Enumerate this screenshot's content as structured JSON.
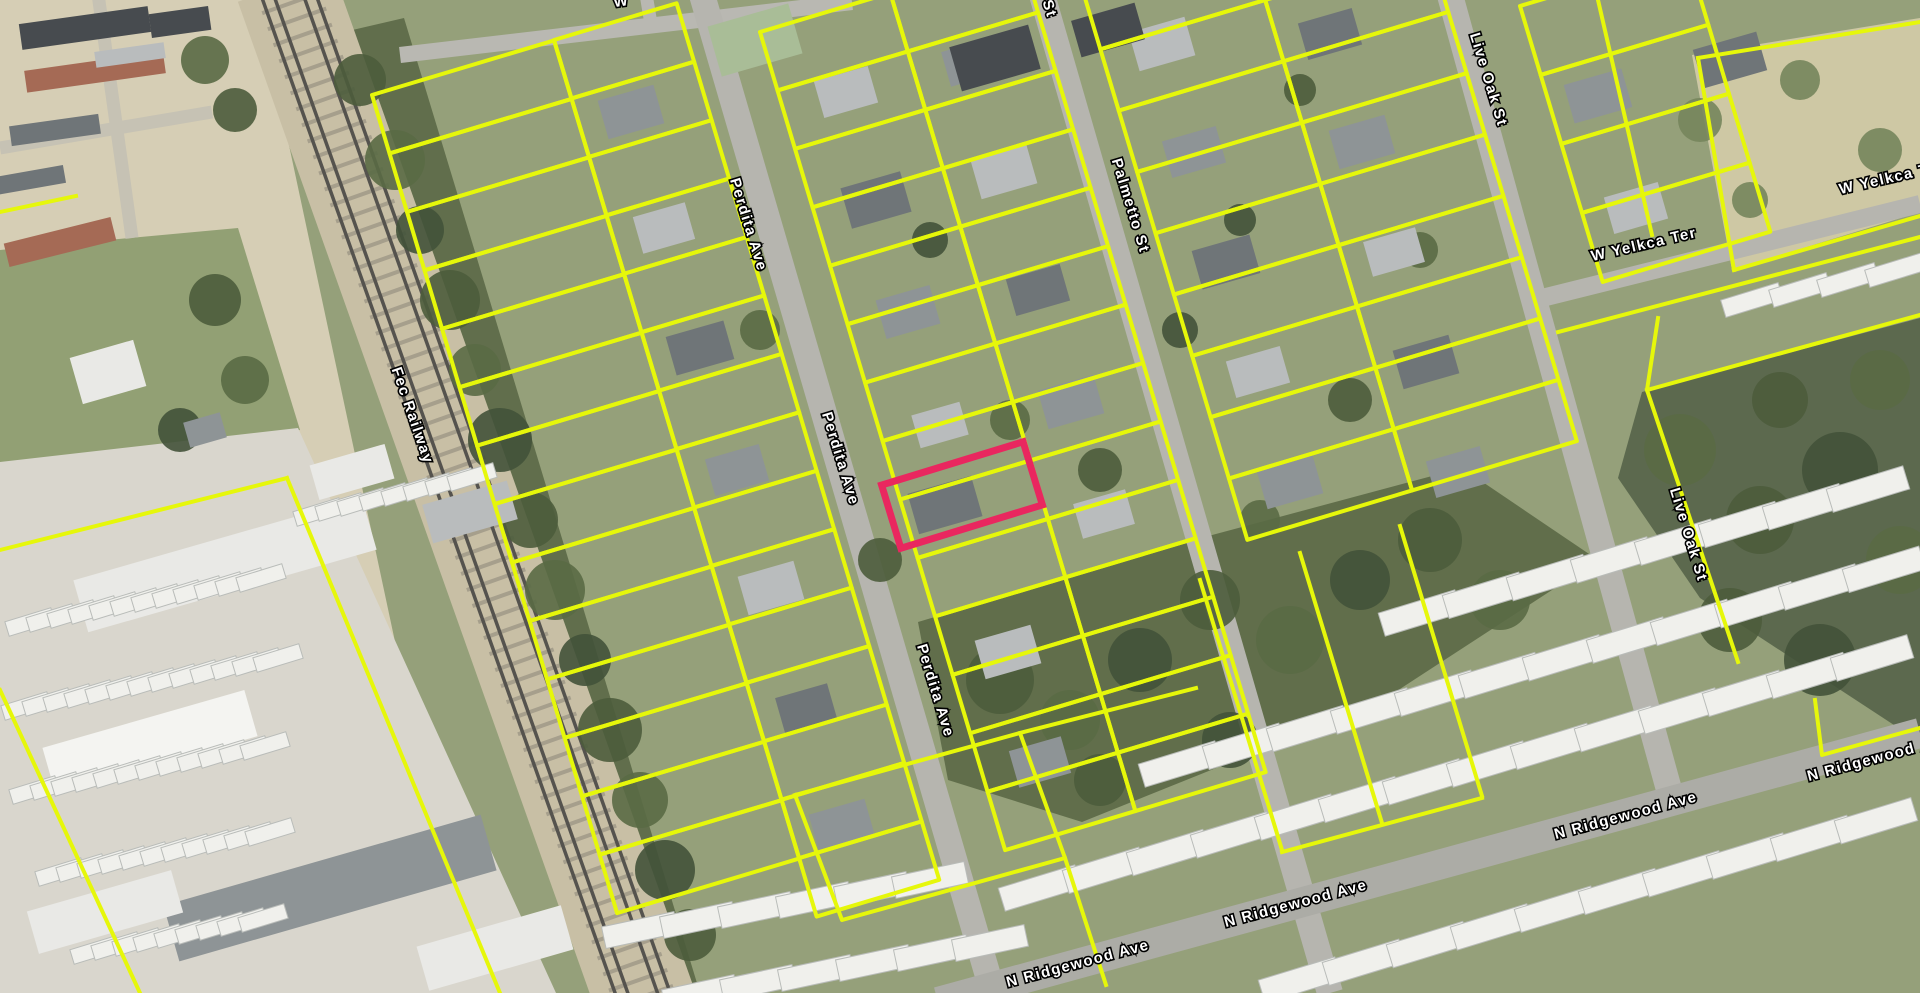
{
  "map": {
    "type": "aerial-parcel-map",
    "parcel_line_color": "#e6f70a",
    "selected_parcel_color": "#e9275f",
    "street_labels": [
      {
        "text": "Fec Railway",
        "x": 408,
        "y": 417,
        "rot": 71
      },
      {
        "text": "Perdita Ave",
        "x": 744,
        "y": 226,
        "rot": 73
      },
      {
        "text": "Perdita Ave",
        "x": 836,
        "y": 460,
        "rot": 73
      },
      {
        "text": "Perdita Ave",
        "x": 931,
        "y": 692,
        "rot": 73
      },
      {
        "text": "St",
        "x": 1045,
        "y": 10,
        "rot": 73
      },
      {
        "text": "Palmetto St",
        "x": 1126,
        "y": 207,
        "rot": 73
      },
      {
        "text": "Live Oak St",
        "x": 1484,
        "y": 81,
        "rot": 73
      },
      {
        "text": "Live Oak St",
        "x": 1684,
        "y": 536,
        "rot": 73
      },
      {
        "text": "W Yelkca Ter",
        "x": 1645,
        "y": 249,
        "rot": -13
      },
      {
        "text": "W Yelkca Ter",
        "x": 1893,
        "y": 182,
        "rot": -13
      },
      {
        "text": "N Ridgewood Ave",
        "x": 1079,
        "y": 968,
        "rot": -15
      },
      {
        "text": "N Ridgewood Ave",
        "x": 1297,
        "y": 908,
        "rot": -15
      },
      {
        "text": "N Ridgewood Ave",
        "x": 1627,
        "y": 820,
        "rot": -15
      },
      {
        "text": "N Ridgewood Ave",
        "x": 1880,
        "y": 762,
        "rot": -15
      },
      {
        "text": "W",
        "x": 622,
        "y": 6,
        "rot": -8
      }
    ],
    "selected_parcel": {
      "cx": 962,
      "cy": 495,
      "w": 148,
      "h": 66,
      "rot": -17
    },
    "regions": [
      {
        "p": "0,0 258,0 470,993 0,993",
        "f": "#d6ceb5"
      },
      {
        "p": "0,250 238,228 300,430 0,468",
        "f": "#92a074"
      },
      {
        "p": "0,462 298,428 556,993 0,993",
        "f": "#d9d6cd"
      },
      {
        "p": "1692,55 1920,18 1920,212 1732,270",
        "f": "#cec8a4"
      }
    ],
    "woods": [
      {
        "p": "318,38 404,18 700,993 598,993",
        "f": "#5d6b48"
      },
      {
        "p": "918,622 1186,542 1462,468 1598,560 1380,702 1082,822 948,780",
        "f": "#5c6a47"
      },
      {
        "p": "1642,392 1920,318 1920,742 1700,598 1618,478",
        "f": "#57654a"
      }
    ],
    "tree_colors": [
      "#4d5c3c",
      "#5a6a45",
      "#43523a",
      "#76855c"
    ],
    "trees": [
      [
        360,
        80,
        26,
        0
      ],
      [
        395,
        160,
        30,
        1
      ],
      [
        420,
        230,
        24,
        2
      ],
      [
        450,
        300,
        30,
        0
      ],
      [
        475,
        370,
        26,
        1
      ],
      [
        500,
        440,
        32,
        2
      ],
      [
        530,
        520,
        28,
        0
      ],
      [
        555,
        590,
        30,
        1
      ],
      [
        585,
        660,
        26,
        2
      ],
      [
        610,
        730,
        32,
        0
      ],
      [
        640,
        800,
        28,
        1
      ],
      [
        665,
        870,
        30,
        2
      ],
      [
        690,
        935,
        26,
        0
      ],
      [
        760,
        330,
        20,
        1
      ],
      [
        880,
        560,
        22,
        0
      ],
      [
        930,
        240,
        18,
        2
      ],
      [
        1010,
        420,
        20,
        1
      ],
      [
        1100,
        470,
        22,
        0
      ],
      [
        1180,
        330,
        18,
        2
      ],
      [
        1260,
        520,
        20,
        1
      ],
      [
        1350,
        400,
        22,
        0
      ],
      [
        1240,
        220,
        16,
        2
      ],
      [
        1420,
        250,
        18,
        1
      ],
      [
        1300,
        90,
        16,
        0
      ],
      [
        1000,
        680,
        34,
        0
      ],
      [
        1070,
        720,
        30,
        1
      ],
      [
        1140,
        660,
        32,
        2
      ],
      [
        1210,
        600,
        30,
        0
      ],
      [
        1290,
        640,
        34,
        1
      ],
      [
        1360,
        580,
        30,
        2
      ],
      [
        1430,
        540,
        32,
        0
      ],
      [
        1500,
        600,
        30,
        1
      ],
      [
        1230,
        740,
        28,
        2
      ],
      [
        1100,
        780,
        26,
        0
      ],
      [
        1680,
        450,
        36,
        1
      ],
      [
        1760,
        520,
        34,
        0
      ],
      [
        1840,
        470,
        38,
        2
      ],
      [
        1900,
        560,
        34,
        1
      ],
      [
        1730,
        620,
        32,
        0
      ],
      [
        1820,
        660,
        36,
        2
      ],
      [
        1880,
        380,
        30,
        1
      ],
      [
        1780,
        400,
        28,
        0
      ],
      [
        1700,
        120,
        22,
        3
      ],
      [
        1800,
        80,
        20,
        3
      ],
      [
        1880,
        150,
        22,
        3
      ],
      [
        1750,
        200,
        18,
        3
      ],
      [
        215,
        300,
        26,
        0
      ],
      [
        245,
        380,
        24,
        1
      ],
      [
        180,
        430,
        22,
        2
      ],
      [
        205,
        60,
        24,
        1
      ],
      [
        235,
        110,
        22,
        0
      ]
    ],
    "roads": [
      [
        400,
        55,
        852,
        2,
        16,
        "#b9b8b2"
      ],
      [
        652,
        30,
        645,
        -12,
        13,
        "#b9b8b2"
      ],
      [
        700,
        -12,
        993,
        993,
        26,
        "#b6b5af"
      ],
      [
        1040,
        -12,
        1330,
        993,
        26,
        "#b6b5af"
      ],
      [
        1448,
        -12,
        1676,
        815,
        26,
        "#b6b5af"
      ],
      [
        1534,
        300,
        1920,
        204,
        18,
        "#b6b5af"
      ],
      [
        938,
        1002,
        1920,
        733,
        30,
        "#acaca6"
      ],
      [
        0,
        148,
        212,
        112,
        13,
        "#c6c2b4"
      ],
      [
        98,
        -6,
        132,
        238,
        13,
        "#c6c2b4"
      ]
    ],
    "railway": {
      "x1": 285,
      "y1": -15,
      "x2": 648,
      "y2": 1008,
      "band_w": 100,
      "band_color": "#c8bfa5",
      "tie_color": "#8b8578",
      "rail_color": "#55534e",
      "rail_offsets": [
        -26,
        -14,
        14,
        26
      ]
    },
    "building_colors": [
      "#8e9496",
      "#b9bcbd",
      "#6f7578",
      "#e9e9e6",
      "#f4f4f1",
      "#a9bd97",
      "#a56a55",
      "#474b4f"
    ],
    "buildings": [
      [
        631,
        112,
        58,
        40,
        -16,
        0
      ],
      [
        664,
        228,
        54,
        38,
        -16,
        1
      ],
      [
        700,
        348,
        60,
        40,
        -16,
        2
      ],
      [
        737,
        470,
        56,
        38,
        -16,
        0
      ],
      [
        771,
        588,
        58,
        40,
        -16,
        1
      ],
      [
        806,
        708,
        54,
        36,
        -16,
        2
      ],
      [
        842,
        826,
        58,
        40,
        -16,
        0
      ],
      [
        846,
        92,
        56,
        38,
        -16,
        1
      ],
      [
        876,
        200,
        62,
        42,
        -16,
        2
      ],
      [
        908,
        312,
        56,
        40,
        -16,
        0
      ],
      [
        940,
        425,
        50,
        34,
        -16,
        1
      ],
      [
        945,
        505,
        66,
        42,
        -16,
        2
      ],
      [
        1008,
        652,
        58,
        40,
        -16,
        1
      ],
      [
        1040,
        762,
        54,
        38,
        -16,
        0
      ],
      [
        972,
        62,
        54,
        36,
        -16,
        0
      ],
      [
        1004,
        172,
        58,
        40,
        -16,
        1
      ],
      [
        1038,
        290,
        56,
        38,
        -16,
        2
      ],
      [
        1071,
        402,
        58,
        40,
        -16,
        0
      ],
      [
        1104,
        514,
        54,
        36,
        -16,
        1
      ],
      [
        1162,
        44,
        58,
        40,
        -16,
        1
      ],
      [
        1194,
        152,
        56,
        38,
        -16,
        0
      ],
      [
        1226,
        262,
        60,
        40,
        -16,
        2
      ],
      [
        1258,
        372,
        56,
        38,
        -16,
        1
      ],
      [
        1290,
        482,
        58,
        40,
        -16,
        0
      ],
      [
        1330,
        34,
        56,
        38,
        -16,
        2
      ],
      [
        1362,
        142,
        58,
        40,
        -16,
        0
      ],
      [
        1394,
        252,
        54,
        36,
        -16,
        1
      ],
      [
        1426,
        362,
        58,
        40,
        -16,
        2
      ],
      [
        1458,
        472,
        56,
        38,
        -16,
        0
      ],
      [
        1598,
        96,
        60,
        40,
        -16,
        0
      ],
      [
        1636,
        208,
        56,
        38,
        -16,
        1
      ],
      [
        1730,
        60,
        66,
        40,
        -16,
        2
      ],
      [
        755,
        40,
        84,
        52,
        -16,
        5
      ],
      [
        995,
        58,
        82,
        46,
        -16,
        7
      ],
      [
        1108,
        30,
        66,
        38,
        -16,
        7
      ],
      [
        108,
        372,
        66,
        48,
        -16,
        3
      ],
      [
        205,
        430,
        38,
        26,
        -16,
        0
      ],
      [
        225,
        565,
        300,
        54,
        -16,
        3
      ],
      [
        150,
        742,
        210,
        48,
        -16,
        4
      ],
      [
        330,
        888,
        330,
        58,
        -16,
        0
      ],
      [
        495,
        948,
        150,
        46,
        -16,
        3
      ],
      [
        105,
        912,
        150,
        44,
        -16,
        3
      ],
      [
        352,
        472,
        78,
        36,
        -16,
        3
      ],
      [
        470,
        512,
        88,
        40,
        -16,
        1
      ],
      [
        85,
        28,
        130,
        26,
        -8,
        7
      ],
      [
        95,
        72,
        140,
        22,
        -8,
        6
      ],
      [
        55,
        130,
        90,
        20,
        -8,
        2
      ],
      [
        180,
        22,
        60,
        24,
        -8,
        7
      ],
      [
        130,
        55,
        70,
        16,
        -8,
        1
      ],
      [
        60,
        242,
        110,
        24,
        -14,
        6
      ],
      [
        30,
        180,
        70,
        18,
        -10,
        2
      ]
    ],
    "vehicle_rows": [
      [
        30,
        622,
        21,
        -4,
        12,
        15,
        48,
        73
      ],
      [
        26,
        706,
        21,
        -4,
        13,
        15,
        48,
        73
      ],
      [
        34,
        790,
        21,
        -4,
        12,
        15,
        48,
        73
      ],
      [
        60,
        872,
        21,
        -4,
        11,
        15,
        48,
        73
      ],
      [
        95,
        950,
        21,
        -4,
        9,
        15,
        48,
        73
      ],
      [
        318,
        512,
        22,
        -5,
        8,
        15,
        48,
        73
      ],
      [
        1040,
        888,
        64,
        -17.7,
        14,
        24,
        80,
        73
      ],
      [
        1180,
        764,
        64,
        -17.7,
        12,
        24,
        80,
        73
      ],
      [
        1420,
        613,
        64,
        -17.7,
        8,
        24,
        80,
        73
      ],
      [
        1752,
        300,
        48,
        -10,
        4,
        18,
        60,
        73
      ],
      [
        1300,
        980,
        64,
        -17.7,
        10,
        24,
        80,
        73
      ],
      [
        640,
        930,
        58,
        -10,
        6,
        22,
        74,
        78
      ],
      [
        700,
        993,
        58,
        -10,
        6,
        22,
        74,
        78
      ]
    ],
    "parcel_grid": {
      "u": [
        0.958,
        -0.287
      ],
      "v": [
        0.287,
        0.958
      ],
      "blocks": [
        {
          "o": [
            372,
            95
          ],
          "cols": 1,
          "rows": 14,
          "cw": 190,
          "ch": 61
        },
        {
          "o": [
            554,
            40
          ],
          "cols": 1,
          "rows": 15,
          "cw": 128,
          "ch": 61
        },
        {
          "o": [
            760,
            32
          ],
          "cols": 2,
          "rows": 14,
          "cw": 136,
          "ch": 61
        },
        {
          "o": [
            1082,
            -12
          ],
          "cols": 2,
          "rows": 9,
          "cw": 172,
          "ch": 64
        },
        {
          "o": [
            1520,
            6
          ],
          "cols": 1,
          "rows": 4,
          "cw": 175,
          "ch": 72
        }
      ]
    },
    "parcel_lines": [
      "795,795 1020,733 1065,858 842,920 795,795",
      "1065,858 1106,985",
      "1020,733 1196,688",
      "1815,700 1822,755 1920,728",
      "1658,318 1647,390 1738,662",
      "1647,390 1920,315",
      "1558,332 1920,237",
      "1698,58 1920,22",
      "1698,58 1734,270",
      "1734,270 1920,216",
      "1598,0 1652,235",
      "0,212 76,196",
      "287,478 0,550",
      "287,478 500,993",
      "0,690 140,993",
      "1200,580 1282,850",
      "1300,553 1382,823",
      "1400,526 1482,796",
      "1282,852 1482,798"
    ]
  }
}
